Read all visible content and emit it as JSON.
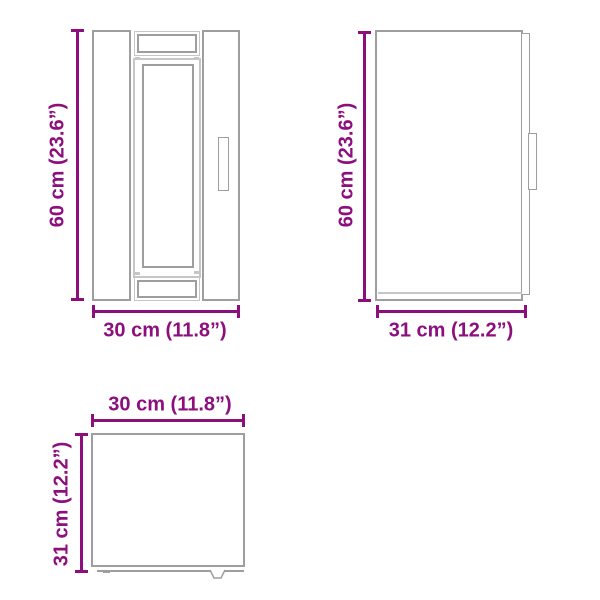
{
  "page": {
    "background": "#ffffff",
    "description": "Cabinet dimension diagram with front, side and top views"
  },
  "colors": {
    "dimension": "#8C0F7D",
    "outline": "#9E9E9E",
    "outline_light": "#C6C6C6"
  },
  "views": {
    "front": {
      "height": {
        "label": "60 cm (23.6”)",
        "cm": 60,
        "inches": 23.6
      },
      "width": {
        "label": "30 cm (11.8”)",
        "cm": 30,
        "inches": 11.8
      }
    },
    "side": {
      "height": {
        "label": "60 cm (23.6”)",
        "cm": 60,
        "inches": 23.6
      },
      "depth": {
        "label": "31 cm (12.2”)",
        "cm": 31,
        "inches": 12.2
      }
    },
    "top": {
      "width": {
        "label": "30 cm (11.8”)",
        "cm": 30,
        "inches": 11.8
      },
      "depth": {
        "label": "31 cm (12.2”)",
        "cm": 31,
        "inches": 12.2
      }
    }
  }
}
